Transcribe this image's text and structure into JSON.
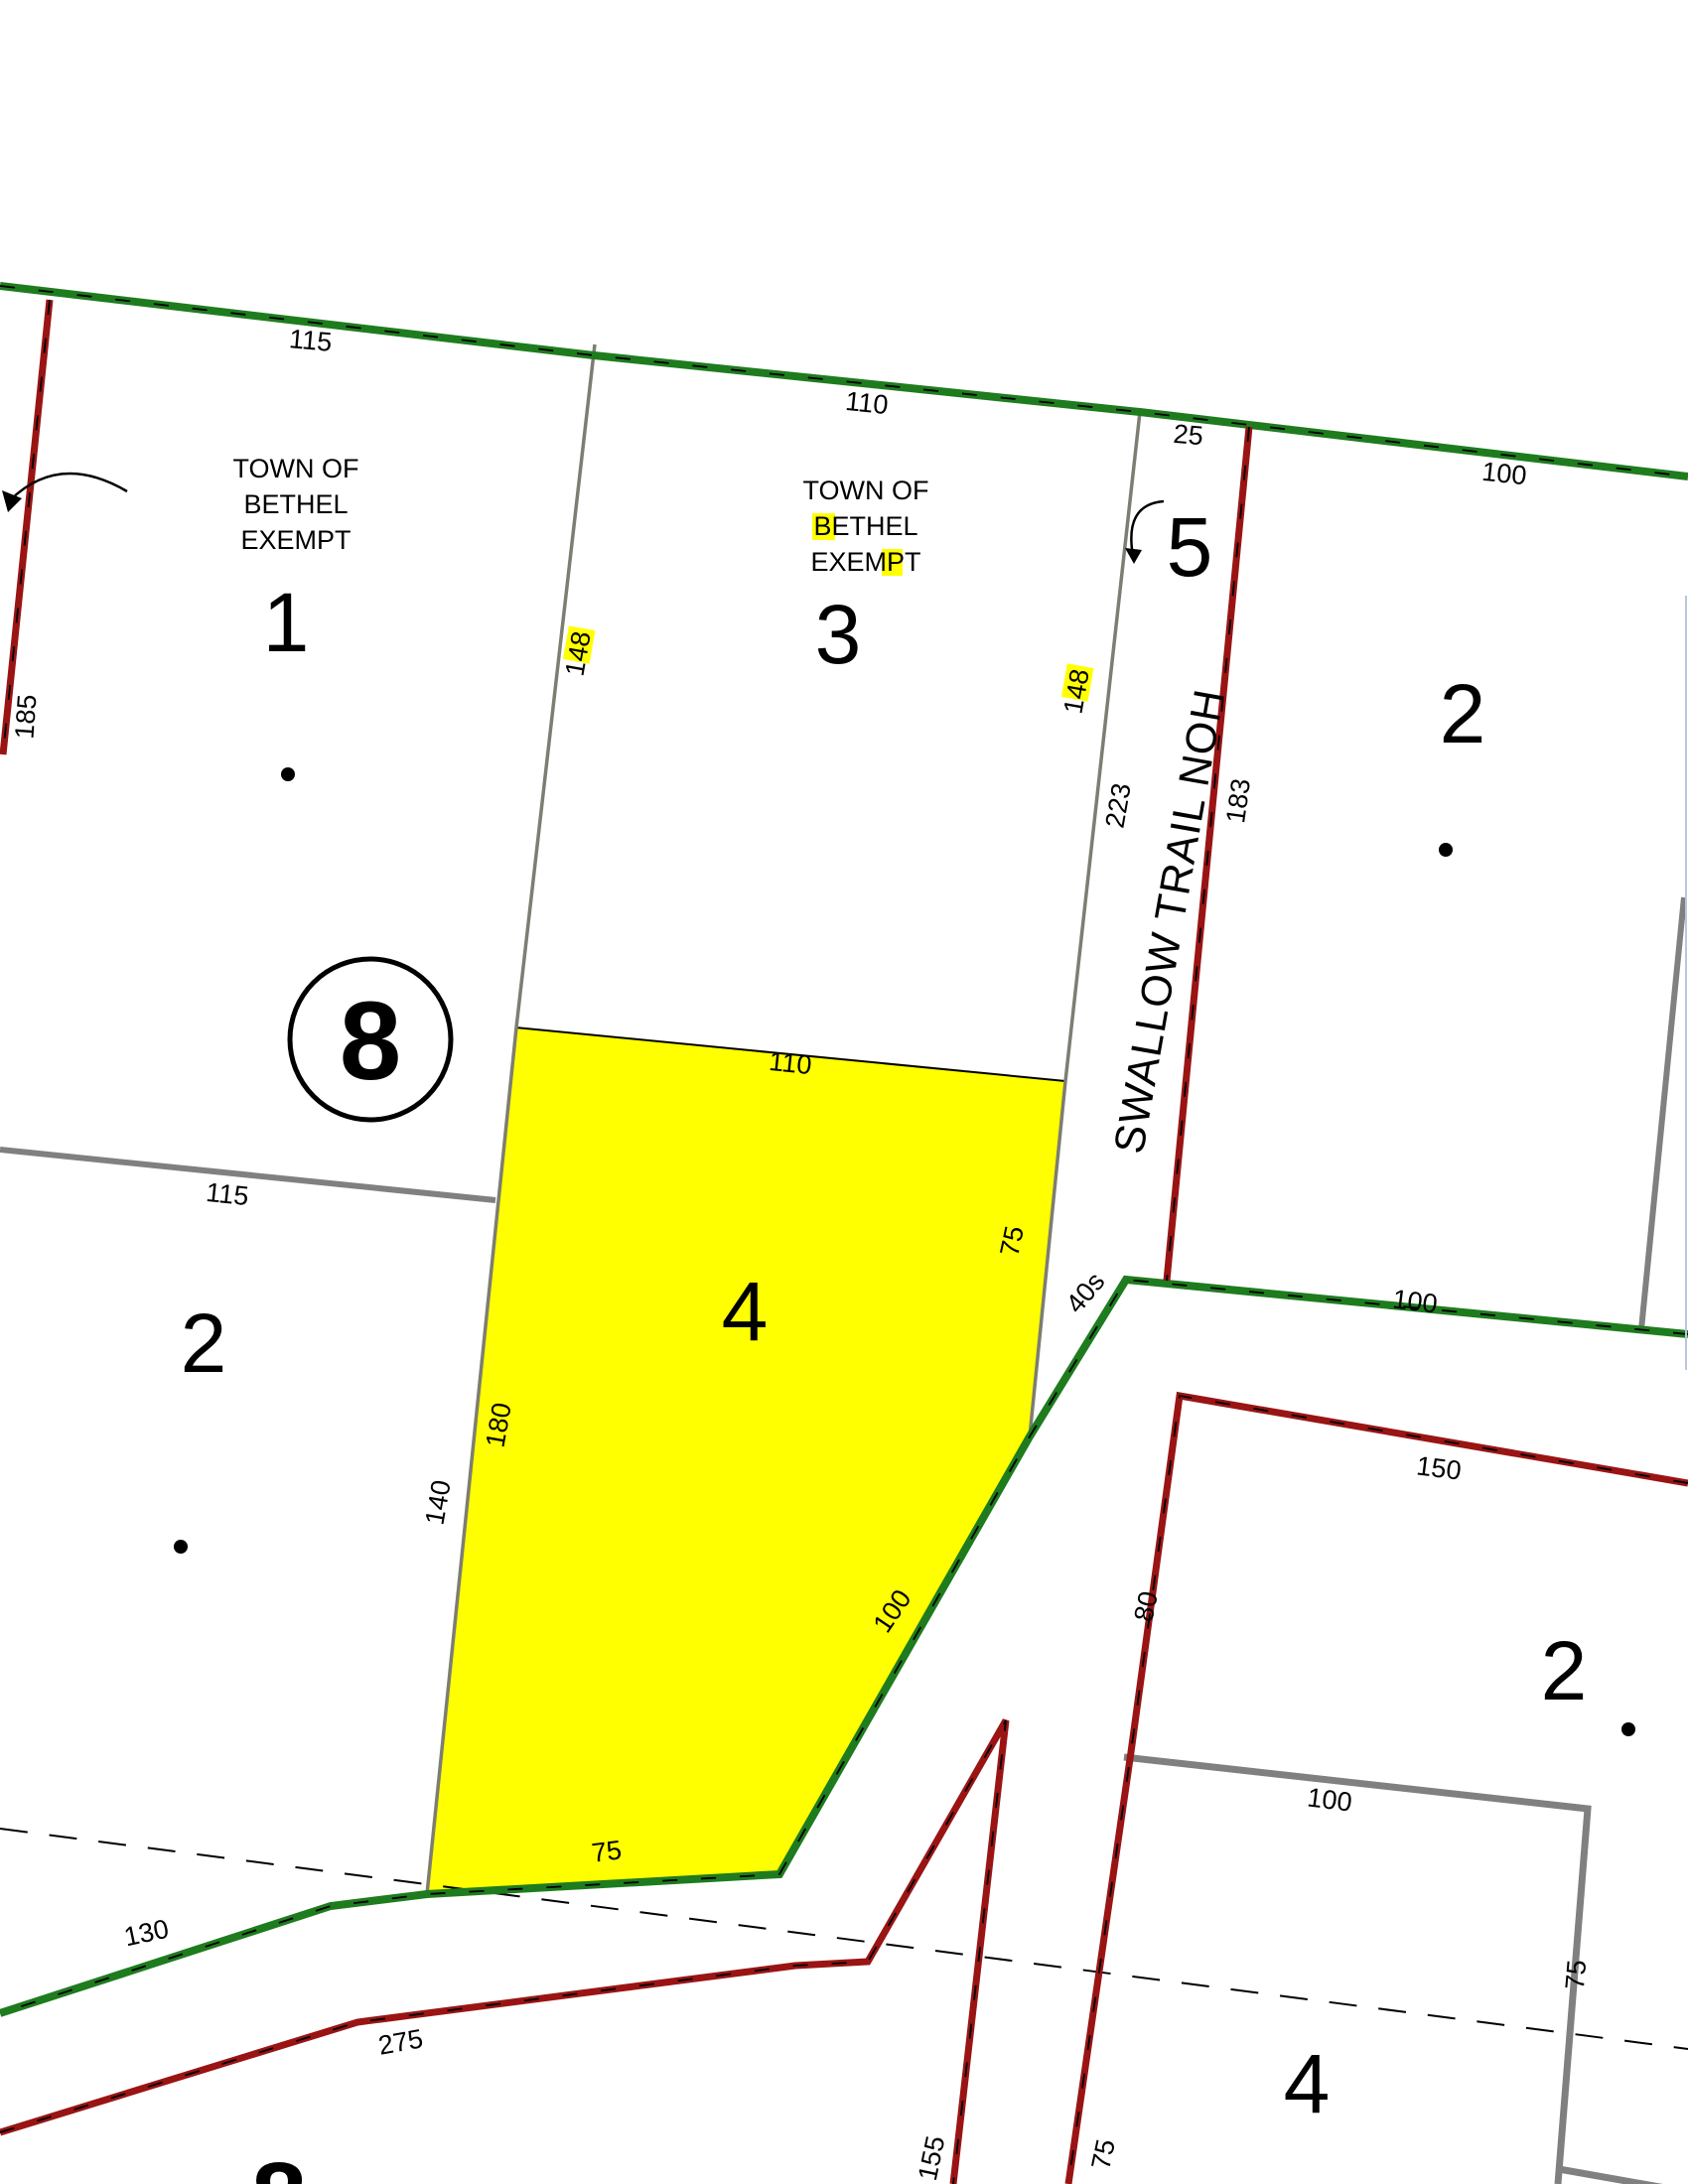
{
  "colors": {
    "background": "#ffffff",
    "road_green": "#1e7c1e",
    "road_red": "#9a1414",
    "boundary_gray": "#808080",
    "parcel_line_gray": "#7d7d72",
    "selected_parcel_fill": "#ffff00",
    "search_highlight": "#ffff00",
    "edge_line_blue": "#b9c6dc"
  },
  "street": {
    "name": "SWALLOW TRAIL NOH"
  },
  "block": {
    "number": "8"
  },
  "parcels": {
    "p1": {
      "number": "1",
      "owner_line1": "TOWN OF",
      "owner_line2": "BETHEL",
      "owner_line3": "EXEMPT"
    },
    "p3": {
      "number": "3",
      "owner_line1": "TOWN OF",
      "owner_line2": "BETHEL",
      "owner_line3": "EXEMPT"
    },
    "p5": {
      "number": "5"
    },
    "p2_top_right": {
      "number": "2"
    },
    "p2_left": {
      "number": "2"
    },
    "p2_right": {
      "number": "2"
    },
    "p4_selected": {
      "number": "4"
    },
    "p4_bottom_right": {
      "number": "4"
    },
    "p8_bottom": {
      "number": "8"
    }
  },
  "dimensions": {
    "d115_top": "115",
    "d110_top": "110",
    "d25": "25",
    "d100_top_right": "100",
    "d185": "185",
    "d148_west": "148",
    "d148_east": "148",
    "d223": "223",
    "d183": "183",
    "d110_selected": "110",
    "d75_selected_right": "75",
    "d40s": "40s",
    "d100_road": "100",
    "d150": "150",
    "d80": "80",
    "d115_mid": "115",
    "d180": "180",
    "d140": "140",
    "d100_diagonal": "100",
    "d75_selected_bottom": "75",
    "d130": "130",
    "d275": "275",
    "d155": "155",
    "d75_spike": "75",
    "d100_bottom_right": "100",
    "d75_bottom_right": "75"
  }
}
